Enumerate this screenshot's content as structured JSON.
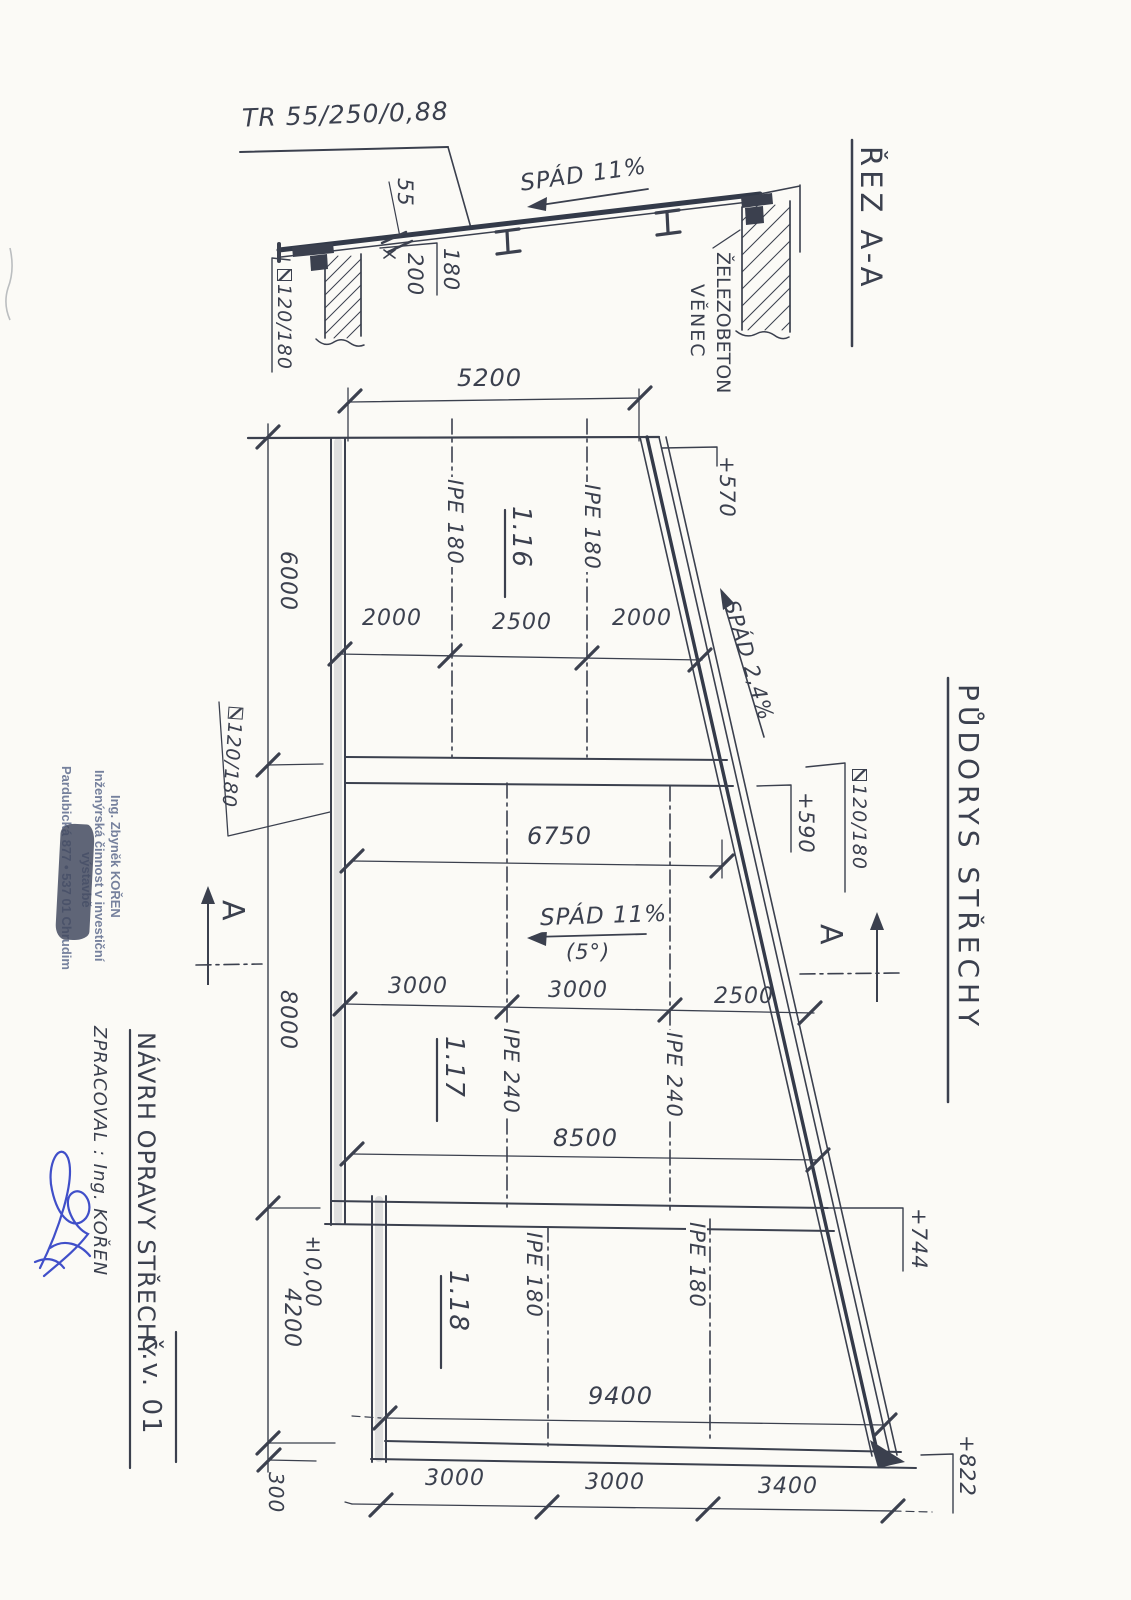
{
  "page": {
    "bg": "#fbfaf6",
    "ink": "#3b404e",
    "stamp_color": "#76819d",
    "signature_color": "#2b3cc4"
  },
  "section": {
    "title": "ŘEZ A-A",
    "tr_label": "TR 55/250/0,88",
    "slope_label": "SPÁD 11%",
    "wall_label_line1": "ŽELEZOBETON",
    "wall_label_line2": "VĚNEC",
    "dim_55": "55",
    "dim_200": "200",
    "dim_180": "180",
    "profile_label": "120/180"
  },
  "plan": {
    "title": "PŮDORYS STŘECHY",
    "marker": "A",
    "top_dim": "5200",
    "row_116": [
      "2000",
      "2500",
      "2000"
    ],
    "dim_6750": "6750",
    "row_117": [
      "3000",
      "3000",
      "2500"
    ],
    "dim_8500": "8500",
    "dim_9400": "9400",
    "row_118": [
      "3000",
      "3000",
      "3400"
    ],
    "left_dims": [
      "6000",
      "8000",
      "4200",
      "300"
    ],
    "levels": {
      "l570": "+570",
      "l590": "+590",
      "l744": "+744",
      "l822": "+822",
      "zero": "±0,00"
    },
    "rooms": [
      "1.16",
      "1.17",
      "1.18"
    ],
    "beam_116": "IPE 180",
    "beam_117": "IPE 240",
    "beam_118": "IPE 180",
    "slope_main": "SPÁD 11%",
    "slope_main_deg": "(5°)",
    "slope_edge": "SPÁD 2,4%",
    "profile_left": "120/180",
    "profile_right": "120/180"
  },
  "titleblock": {
    "project_title": "NÁVRH OPRAVY STŘECHY",
    "drawing_number": "č.v. 01",
    "author_line": "ZPRACOVAL : Ing. KOŘEN",
    "stamp": {
      "line1": "Ing. Zbyněk KOŘEN",
      "line2": "Inženýrská činnost v investiční",
      "line3": "výstavbě",
      "line4": "Pardubická 877 • 537 01 Chrudim"
    }
  }
}
